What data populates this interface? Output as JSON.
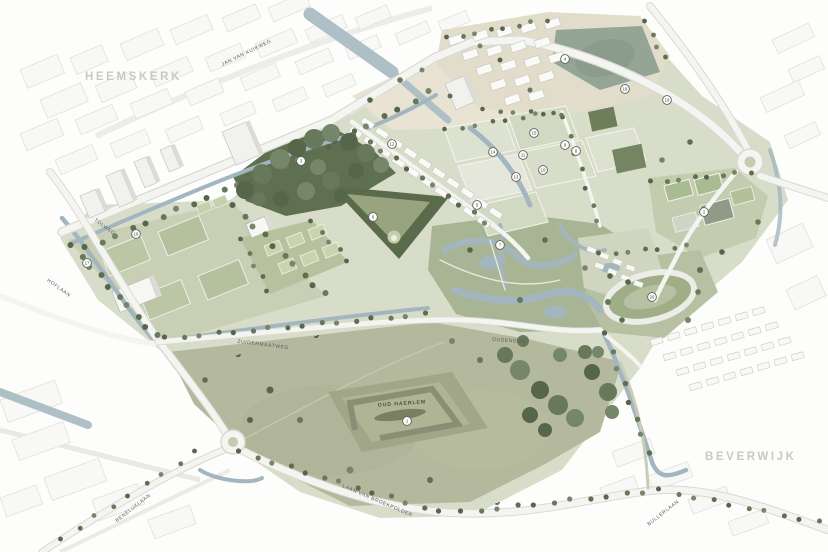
{
  "map": {
    "region_labels": [
      {
        "text": "HEEMSKERK"
      },
      {
        "text": "BEVERWIJK"
      }
    ],
    "road_labels": [
      {
        "text": "JAN VAN KUIKWEG"
      },
      {
        "text": "TOLWEG"
      },
      {
        "text": "HOFLAAN"
      },
      {
        "text": "ZUIDERMAATWEG"
      },
      {
        "text": "OUDENDIJK"
      },
      {
        "text": "LAAN VAN BROEKPOLDER"
      },
      {
        "text": "BENELUXLAAN"
      },
      {
        "text": "BULLERLAAN"
      }
    ],
    "site_labels": [
      {
        "text": "OUD HAERLEM"
      }
    ],
    "markers": [
      {
        "n": "17",
        "x": 87,
        "y": 263
      },
      {
        "n": "16",
        "x": 136,
        "y": 234
      },
      {
        "n": "3",
        "x": 301,
        "y": 161
      },
      {
        "n": "6",
        "x": 373,
        "y": 217
      },
      {
        "n": "12",
        "x": 392,
        "y": 144
      },
      {
        "n": "1",
        "x": 407,
        "y": 421
      },
      {
        "n": "5",
        "x": 477,
        "y": 205
      },
      {
        "n": "14",
        "x": 493,
        "y": 152
      },
      {
        "n": "7",
        "x": 500,
        "y": 245
      },
      {
        "n": "13",
        "x": 516,
        "y": 177
      },
      {
        "n": "11",
        "x": 523,
        "y": 155
      },
      {
        "n": "15",
        "x": 534,
        "y": 133
      },
      {
        "n": "10",
        "x": 543,
        "y": 170
      },
      {
        "n": "4",
        "x": 565,
        "y": 59
      },
      {
        "n": "9",
        "x": 565,
        "y": 145
      },
      {
        "n": "8",
        "x": 576,
        "y": 151
      },
      {
        "n": "18",
        "x": 625,
        "y": 89
      },
      {
        "n": "20",
        "x": 652,
        "y": 297
      },
      {
        "n": "19",
        "x": 667,
        "y": 100
      },
      {
        "n": "2",
        "x": 704,
        "y": 212
      }
    ],
    "colors": {
      "water": "#a3b6bf",
      "forest_green": "#5e6f4f",
      "field_green": "#c8cfb4",
      "meadow_olive": "#b4b89d",
      "housing_beige": "#e2ddcb",
      "road_white": "#f4f4f0",
      "region_label_gray": "#c8c8c6",
      "road_label_gray": "#5a5d5f"
    }
  }
}
